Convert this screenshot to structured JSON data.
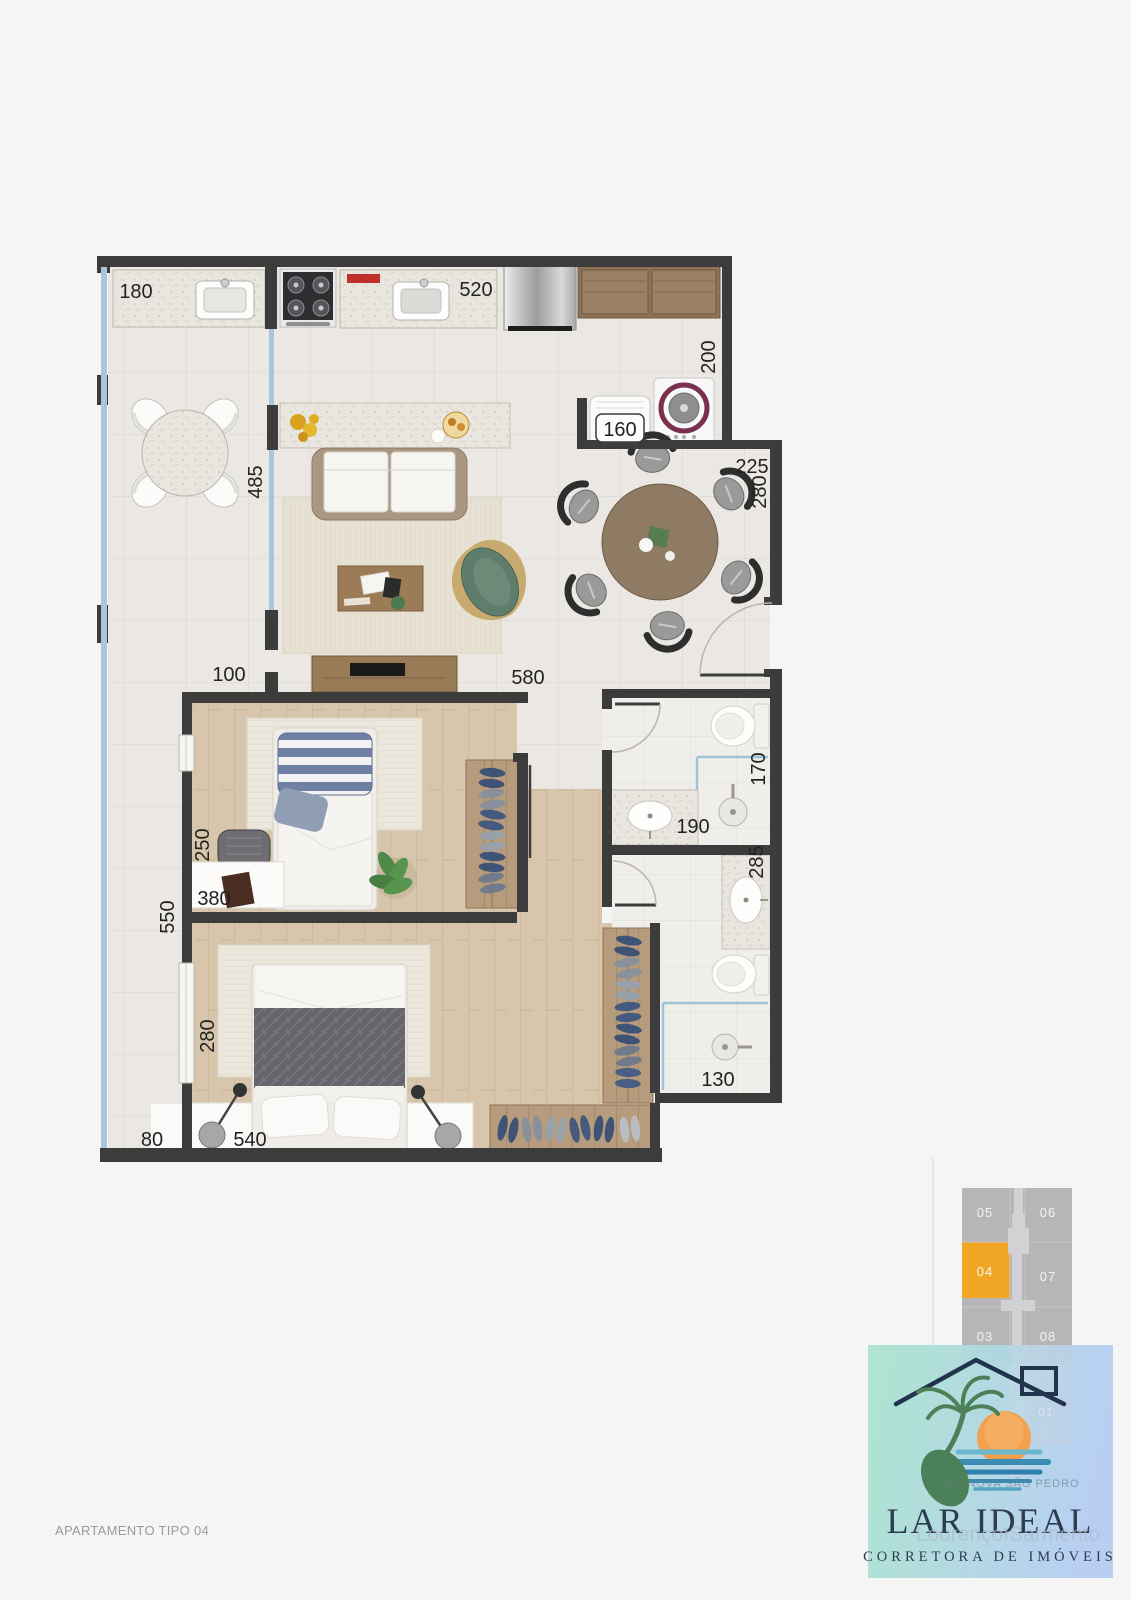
{
  "page": {
    "background": "#f5f5f3",
    "caption": "APARTAMENTO TIPO 04"
  },
  "colors": {
    "wall": "#3c3c3c",
    "glass": "#a9c6e0",
    "floor_tile": "#ebe8e3",
    "wood": "#d6c5aa",
    "keyplan_cell": "#b6b6b9",
    "unit_highlight": "#f2a625",
    "logo_green": "#aae4cd",
    "logo_blue": "#b5cdf3",
    "logo_text": "#2d3b50",
    "sun": "#f2a04e",
    "palm": "#4c8058",
    "water": "#3a8cb5"
  },
  "floor_plan": {
    "dims": {
      "balcony_counter": "180",
      "kitchen_counter": "520",
      "service_depth": "200",
      "service_width": "160",
      "dining_width": "225",
      "dining_depth": "280",
      "balcony_depth": "485",
      "balcony_width": "100",
      "living_width": "580",
      "desk_width": "250",
      "bedroom1_width": "380",
      "bedroom1_depth": "550",
      "bath1_depth": "170",
      "bath1_width": "190",
      "bath2_depth": "285",
      "shower_width": "130",
      "master_depth": "280",
      "balcony_end": "80",
      "master_width": "540"
    }
  },
  "key_plan": {
    "units": [
      {
        "label": "05"
      },
      {
        "label": "06"
      },
      {
        "label": "04"
      },
      {
        "label": "07"
      },
      {
        "label": "03"
      },
      {
        "label": "08"
      }
    ],
    "faint_unit": "01"
  },
  "logo": {
    "watermark_top": "AV. NOVA SÃO PEDRO",
    "title": "LAR IDEAL",
    "watermark_middle": "LourençoISarmento",
    "subtitle": "CORRETORA DE IMÓVEIS"
  }
}
